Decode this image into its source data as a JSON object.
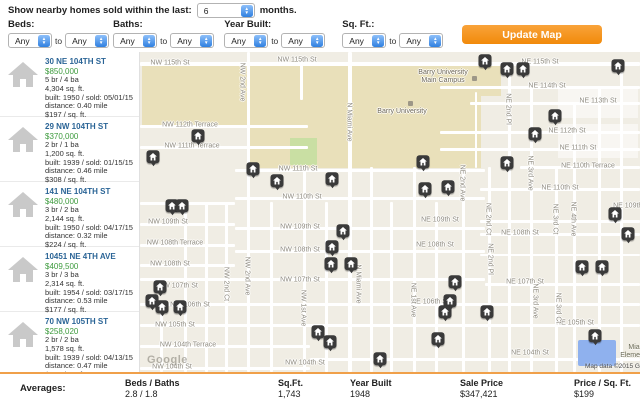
{
  "header": {
    "show_text": "Show nearby homes sold within the last:",
    "months_value": "6",
    "months_suffix": "months.",
    "filters": [
      {
        "label": "Beds:",
        "from": "Any",
        "to_word": "to",
        "to": "Any"
      },
      {
        "label": "Baths:",
        "from": "Any",
        "to_word": "to",
        "to": "Any"
      },
      {
        "label": "Year Built:",
        "from": "Any",
        "to_word": "to",
        "to": "Any"
      },
      {
        "label": "Sq. Ft.:",
        "from": "Any",
        "to_word": "to",
        "to": "Any"
      }
    ],
    "update_button": "Update Map"
  },
  "listings": [
    {
      "address": "30 NE 104TH ST",
      "price": "$850,000",
      "beds_baths": "5 br / 4 ba",
      "sqft": "4,304 sq. ft.",
      "built_sold": "built: 1950 / sold: 05/01/15",
      "distance": "distance: 0.40 mile",
      "ppsf": "$197 / sq. ft."
    },
    {
      "address": "29 NW 104TH ST",
      "price": "$370,000",
      "beds_baths": "2 br / 1 ba",
      "sqft": "1,200 sq. ft.",
      "built_sold": "built: 1939 / sold: 01/15/15",
      "distance": "distance: 0.46 mile",
      "ppsf": "$308 / sq. ft."
    },
    {
      "address": "141 NE 104TH ST",
      "price": "$480,000",
      "beds_baths": "3 br / 2 ba",
      "sqft": "2,144 sq. ft.",
      "built_sold": "built: 1950 / sold: 04/17/15",
      "distance": "distance: 0.32 mile",
      "ppsf": "$224 / sq. ft."
    },
    {
      "address": "10451 NE 4TH AVE",
      "price": "$409,500",
      "beds_baths": "3 br / 3 ba",
      "sqft": "2,314 sq. ft.",
      "built_sold": "built: 1954 / sold: 03/17/15",
      "distance": "distance: 0.53 mile",
      "ppsf": "$177 / sq. ft."
    },
    {
      "address": "70 NW 105TH ST",
      "price": "$258,020",
      "beds_baths": "2 br / 2 ba",
      "sqft": "1,578 sq. ft.",
      "built_sold": "built: 1939 / sold: 04/13/15",
      "distance": "distance: 0.47 mile",
      "ppsf": "$164 / sq. ft."
    }
  ],
  "map": {
    "google_logo": "Google",
    "attribution": "Map data ©2015 G",
    "building_label_lines": [
      "Mia",
      "Element."
    ],
    "poi_labels": [
      {
        "lines": [
          "Barry University",
          "Main Campus"
        ],
        "x": 303,
        "y": 25
      },
      {
        "lines": [
          "Barry University"
        ],
        "x": 262,
        "y": 60
      }
    ],
    "street_labels": [
      {
        "text": "NW 115th St",
        "x": 30,
        "y": 11
      },
      {
        "text": "NW 115th St",
        "x": 157,
        "y": 8
      },
      {
        "text": "NE 115th St",
        "x": 400,
        "y": 10
      },
      {
        "text": "NE 114th St",
        "x": 407,
        "y": 34
      },
      {
        "text": "NE 113th St",
        "x": 458,
        "y": 49
      },
      {
        "text": "NE 112th St",
        "x": 427,
        "y": 79
      },
      {
        "text": "NE 111th St",
        "x": 438,
        "y": 96
      },
      {
        "text": "NW 112th Terrace",
        "x": 50,
        "y": 73
      },
      {
        "text": "NW 111th Terrace",
        "x": 52,
        "y": 94
      },
      {
        "text": "NW 111th St",
        "x": 158,
        "y": 117
      },
      {
        "text": "NE 110th Terrace",
        "x": 448,
        "y": 114
      },
      {
        "text": "NE 110th St",
        "x": 420,
        "y": 136
      },
      {
        "text": "NW 110th St",
        "x": 162,
        "y": 145
      },
      {
        "text": "NW 109th St",
        "x": 28,
        "y": 170
      },
      {
        "text": "NW 109th St",
        "x": 160,
        "y": 175
      },
      {
        "text": "NE 109th St",
        "x": 300,
        "y": 168
      },
      {
        "text": "NE 109th St",
        "x": 492,
        "y": 154
      },
      {
        "text": "NW 108th Terrace",
        "x": 35,
        "y": 191
      },
      {
        "text": "NE 108th St",
        "x": 295,
        "y": 193
      },
      {
        "text": "NE 108th St",
        "x": 380,
        "y": 181
      },
      {
        "text": "NW 108th St",
        "x": 160,
        "y": 198
      },
      {
        "text": "NW 108th St",
        "x": 30,
        "y": 212
      },
      {
        "text": "NW 107th St",
        "x": 38,
        "y": 234
      },
      {
        "text": "NW 107th St",
        "x": 160,
        "y": 228
      },
      {
        "text": "NE 107th St",
        "x": 385,
        "y": 230
      },
      {
        "text": "NW 106th St",
        "x": 50,
        "y": 253
      },
      {
        "text": "NE 106th St",
        "x": 290,
        "y": 250
      },
      {
        "text": "NW 105th St",
        "x": 35,
        "y": 273
      },
      {
        "text": "NE 105th St",
        "x": 435,
        "y": 271
      },
      {
        "text": "NW 104th Terrace",
        "x": 48,
        "y": 293
      },
      {
        "text": "NW 104th St",
        "x": 32,
        "y": 315
      },
      {
        "text": "NW 104th St",
        "x": 165,
        "y": 311
      },
      {
        "text": "NE 104th St",
        "x": 390,
        "y": 301
      },
      {
        "text": "N Miami Ave",
        "x": 209,
        "y": 70,
        "vertical": true
      },
      {
        "text": "N Miami Ave",
        "x": 218,
        "y": 232,
        "vertical": true
      },
      {
        "text": "NW 2nd Ave",
        "x": 102,
        "y": 30,
        "vertical": true
      },
      {
        "text": "NW 2nd Ave",
        "x": 107,
        "y": 224,
        "vertical": true
      },
      {
        "text": "NW 2nd Ct",
        "x": 86,
        "y": 232,
        "vertical": true
      },
      {
        "text": "NW 1st Ave",
        "x": 163,
        "y": 256,
        "vertical": true
      },
      {
        "text": "NE 1st Ave",
        "x": 273,
        "y": 248,
        "vertical": true
      },
      {
        "text": "NE 2nd Ave",
        "x": 322,
        "y": 131,
        "vertical": true
      },
      {
        "text": "NE 2nd Pl",
        "x": 368,
        "y": 57,
        "vertical": true
      },
      {
        "text": "NE 2nd Ct",
        "x": 348,
        "y": 167,
        "vertical": true
      },
      {
        "text": "NE 2nd Pl",
        "x": 350,
        "y": 207,
        "vertical": true
      },
      {
        "text": "NE 3rd Ave",
        "x": 390,
        "y": 121,
        "vertical": true
      },
      {
        "text": "NE 3rd Ct",
        "x": 415,
        "y": 167,
        "vertical": true
      },
      {
        "text": "NE 4th Ave",
        "x": 433,
        "y": 167,
        "vertical": true
      },
      {
        "text": "NE 3rd Ave",
        "x": 395,
        "y": 249,
        "vertical": true
      },
      {
        "text": "NE 3rd Ct",
        "x": 418,
        "y": 256,
        "vertical": true
      }
    ],
    "markers": [
      [
        58,
        85
      ],
      [
        13,
        106
      ],
      [
        113,
        118
      ],
      [
        137,
        130
      ],
      [
        192,
        128
      ],
      [
        32,
        155
      ],
      [
        42,
        155
      ],
      [
        203,
        180
      ],
      [
        192,
        196
      ],
      [
        191,
        213
      ],
      [
        211,
        213
      ],
      [
        20,
        236
      ],
      [
        12,
        250
      ],
      [
        22,
        256
      ],
      [
        40,
        256
      ],
      [
        178,
        281
      ],
      [
        190,
        291
      ],
      [
        240,
        308
      ],
      [
        345,
        10
      ],
      [
        367,
        18
      ],
      [
        383,
        18
      ],
      [
        478,
        15
      ],
      [
        415,
        65
      ],
      [
        395,
        83
      ],
      [
        367,
        112
      ],
      [
        283,
        111
      ],
      [
        285,
        138
      ],
      [
        308,
        136
      ],
      [
        475,
        163
      ],
      [
        488,
        183
      ],
      [
        442,
        216
      ],
      [
        462,
        216
      ],
      [
        315,
        231
      ],
      [
        310,
        250
      ],
      [
        305,
        261
      ],
      [
        347,
        261
      ],
      [
        298,
        288
      ],
      [
        455,
        285
      ]
    ],
    "colors": {
      "campus": "#e9e0ba",
      "park": "#c9dfa3",
      "selected_building": "#8fb1ee",
      "marker_dark": "#3a3a3a",
      "button_orange": "#f7941e",
      "address_blue": "#2a6496",
      "price_green": "#3d9b3d",
      "divider_orange": "#f0a04a"
    }
  },
  "averages": {
    "label": "Averages:",
    "columns": [
      {
        "header": "Beds / Baths",
        "value": "2.8 / 1.8"
      },
      {
        "header": "Sq.Ft.",
        "value": "1,743"
      },
      {
        "header": "Year Built",
        "value": "1948"
      },
      {
        "header": "Sale Price",
        "value": "$347,421"
      },
      {
        "header": "Price / Sq. Ft.",
        "value": "$199"
      }
    ]
  }
}
